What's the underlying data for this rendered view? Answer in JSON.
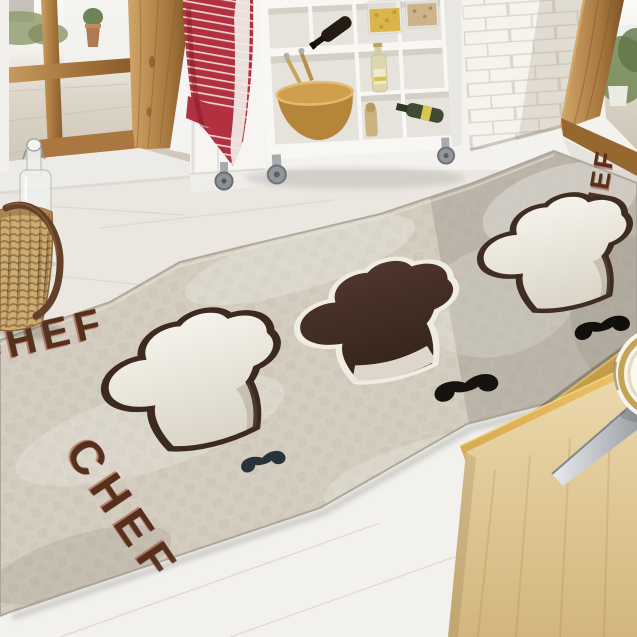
{
  "rug": {
    "texts": {
      "left_edge": "CHEF",
      "bottom_left": "CHEF",
      "top_right": "CHEF"
    },
    "pattern": "checkered-tiles",
    "motifs": [
      "white-chef-hat",
      "brown-chef-hat",
      "white-chef-hat",
      "mustache",
      "mustache",
      "mustache"
    ],
    "colors": {
      "base": "#c1bab0",
      "check_light": "#c6bfb1",
      "check_dark": "#b8b1a3",
      "text": "#57301d",
      "hat_outline": "#3c2a1f",
      "hat_dark_fill": "#422d22",
      "mustache": "#16130f"
    }
  },
  "scene": {
    "objects": [
      "glass-door",
      "red-striped-towel",
      "white-shelf-cart",
      "pasta-jars",
      "wine-bottles",
      "wooden-bowl",
      "white-brick-wall",
      "wooden-door-frame",
      "potted-plant",
      "wicker-basket",
      "swing-top-bottle",
      "wooden-cabinet",
      "cutting-board",
      "knife",
      "plate"
    ],
    "colors": {
      "towel_red": "#b23140",
      "wood_frame": "#b5854a",
      "brick_wall": "#f5f3ee",
      "cart_white": "#f8f7f4",
      "cabinet_wood": "#e0c896",
      "floor": "#edeae3",
      "basket": "#cdac74"
    }
  }
}
